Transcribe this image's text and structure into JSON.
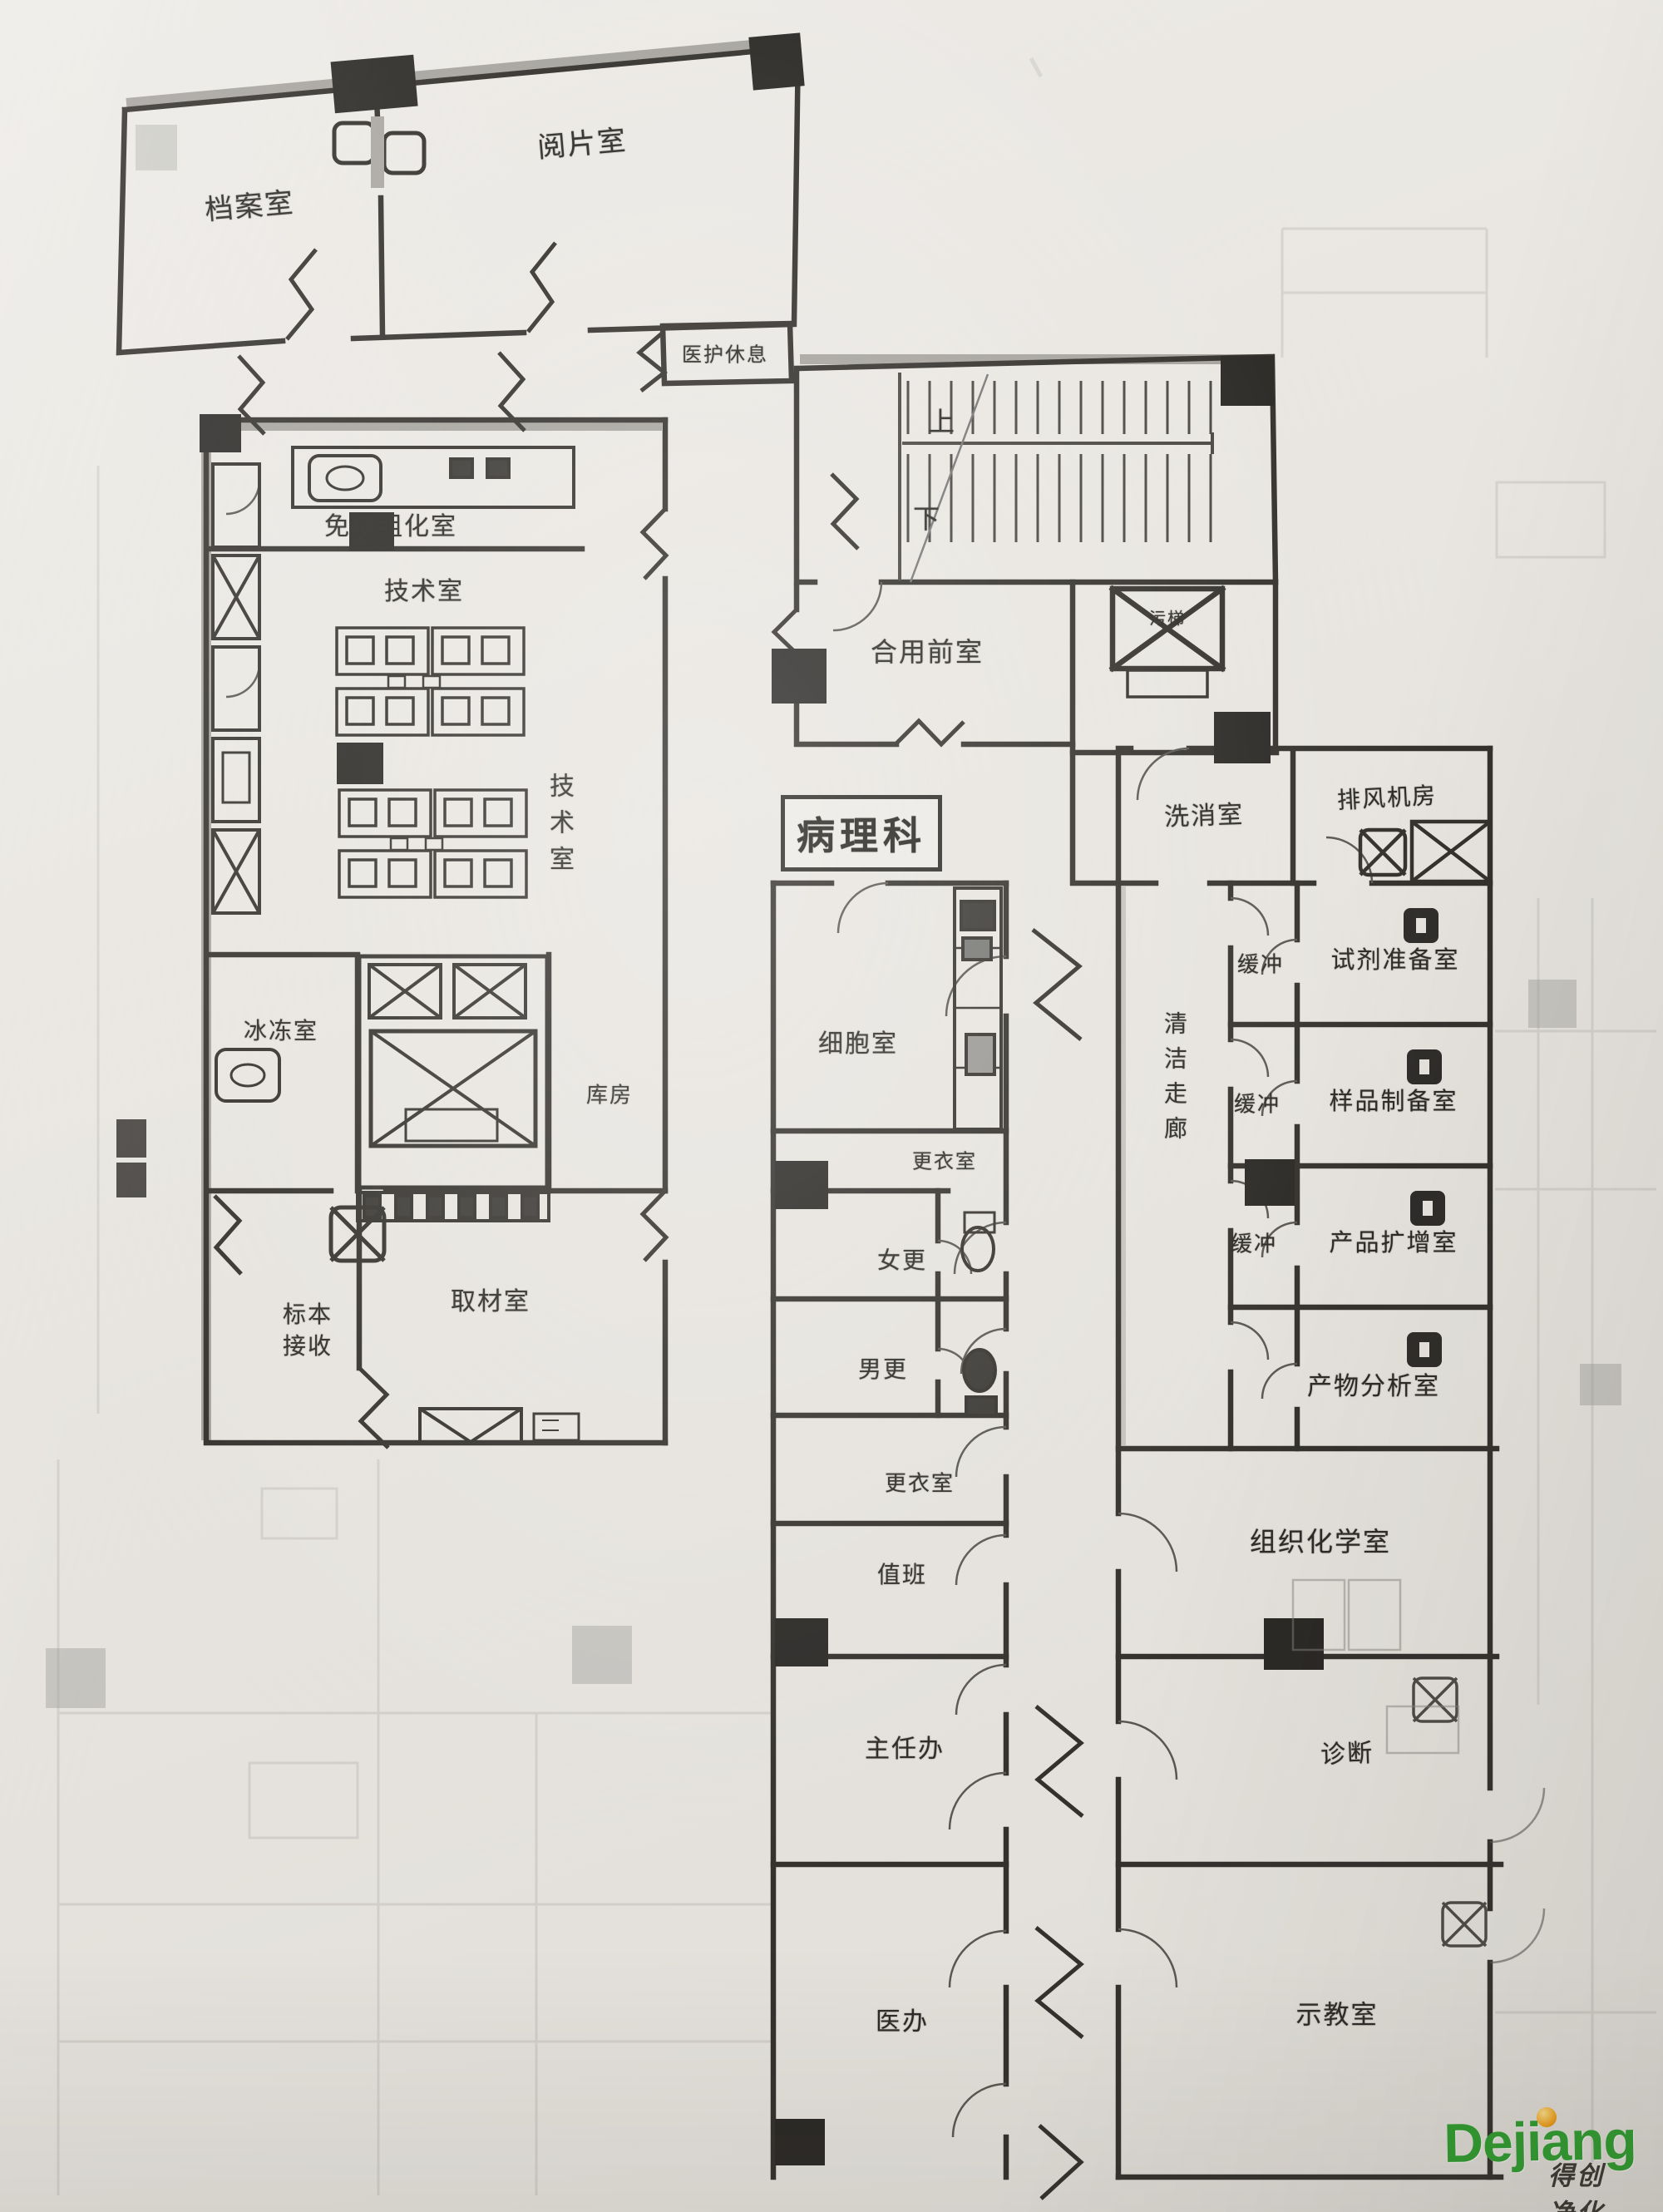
{
  "colors": {
    "ink": "#34312d",
    "paper": "#e8e5e0",
    "wall_gray": "#8f8c87",
    "watermark_green": "#2f9e2f",
    "watermark_dot": "#f2a11a"
  },
  "title": {
    "department": "病理科"
  },
  "stairs": {
    "up": "上",
    "down": "下"
  },
  "rooms": {
    "archive": "档案室",
    "film_reading": "阅片室",
    "staff_rest": "医护休息",
    "shared_anteroom": "合用前室",
    "dirty_elevator": "污梯",
    "washing": "洗消室",
    "exhaust_fan_room": "排风机房",
    "immunohistochemistry": "免疫组化室",
    "tech_room": "技术室",
    "tech_room_vertical": "技术室",
    "frozen": "冰冻室",
    "storage": "库房",
    "grossing": "取材室",
    "specimen_receiving": "标本接收",
    "cell_room": "细胞室",
    "changing_top": "更衣室",
    "female_changing": "女更",
    "male_changing": "男更",
    "changing_bottom": "更衣室",
    "duty": "值班",
    "director_office": "主任办",
    "doctor_office": "医办",
    "clean_corridor": "清洁走廊",
    "buffer_1": "缓冲",
    "reagent_prep": "试剂准备室",
    "buffer_2": "缓冲",
    "sample_prep": "样品制备室",
    "buffer_3": "缓冲",
    "product_amplification": "产品扩增室",
    "product_analysis": "产物分析室",
    "histochemistry": "组织化学室",
    "diagnosis": "诊断",
    "demo_room": "示教室"
  },
  "icons": {
    "shaft_cross": "x-crossed-shaft",
    "door_arc": "door-swing-arc",
    "pass_box": "wall-pass-box",
    "stair_treads": "stair-flight"
  },
  "watermark": {
    "brand": "Dejiang",
    "company": "得创净化"
  }
}
